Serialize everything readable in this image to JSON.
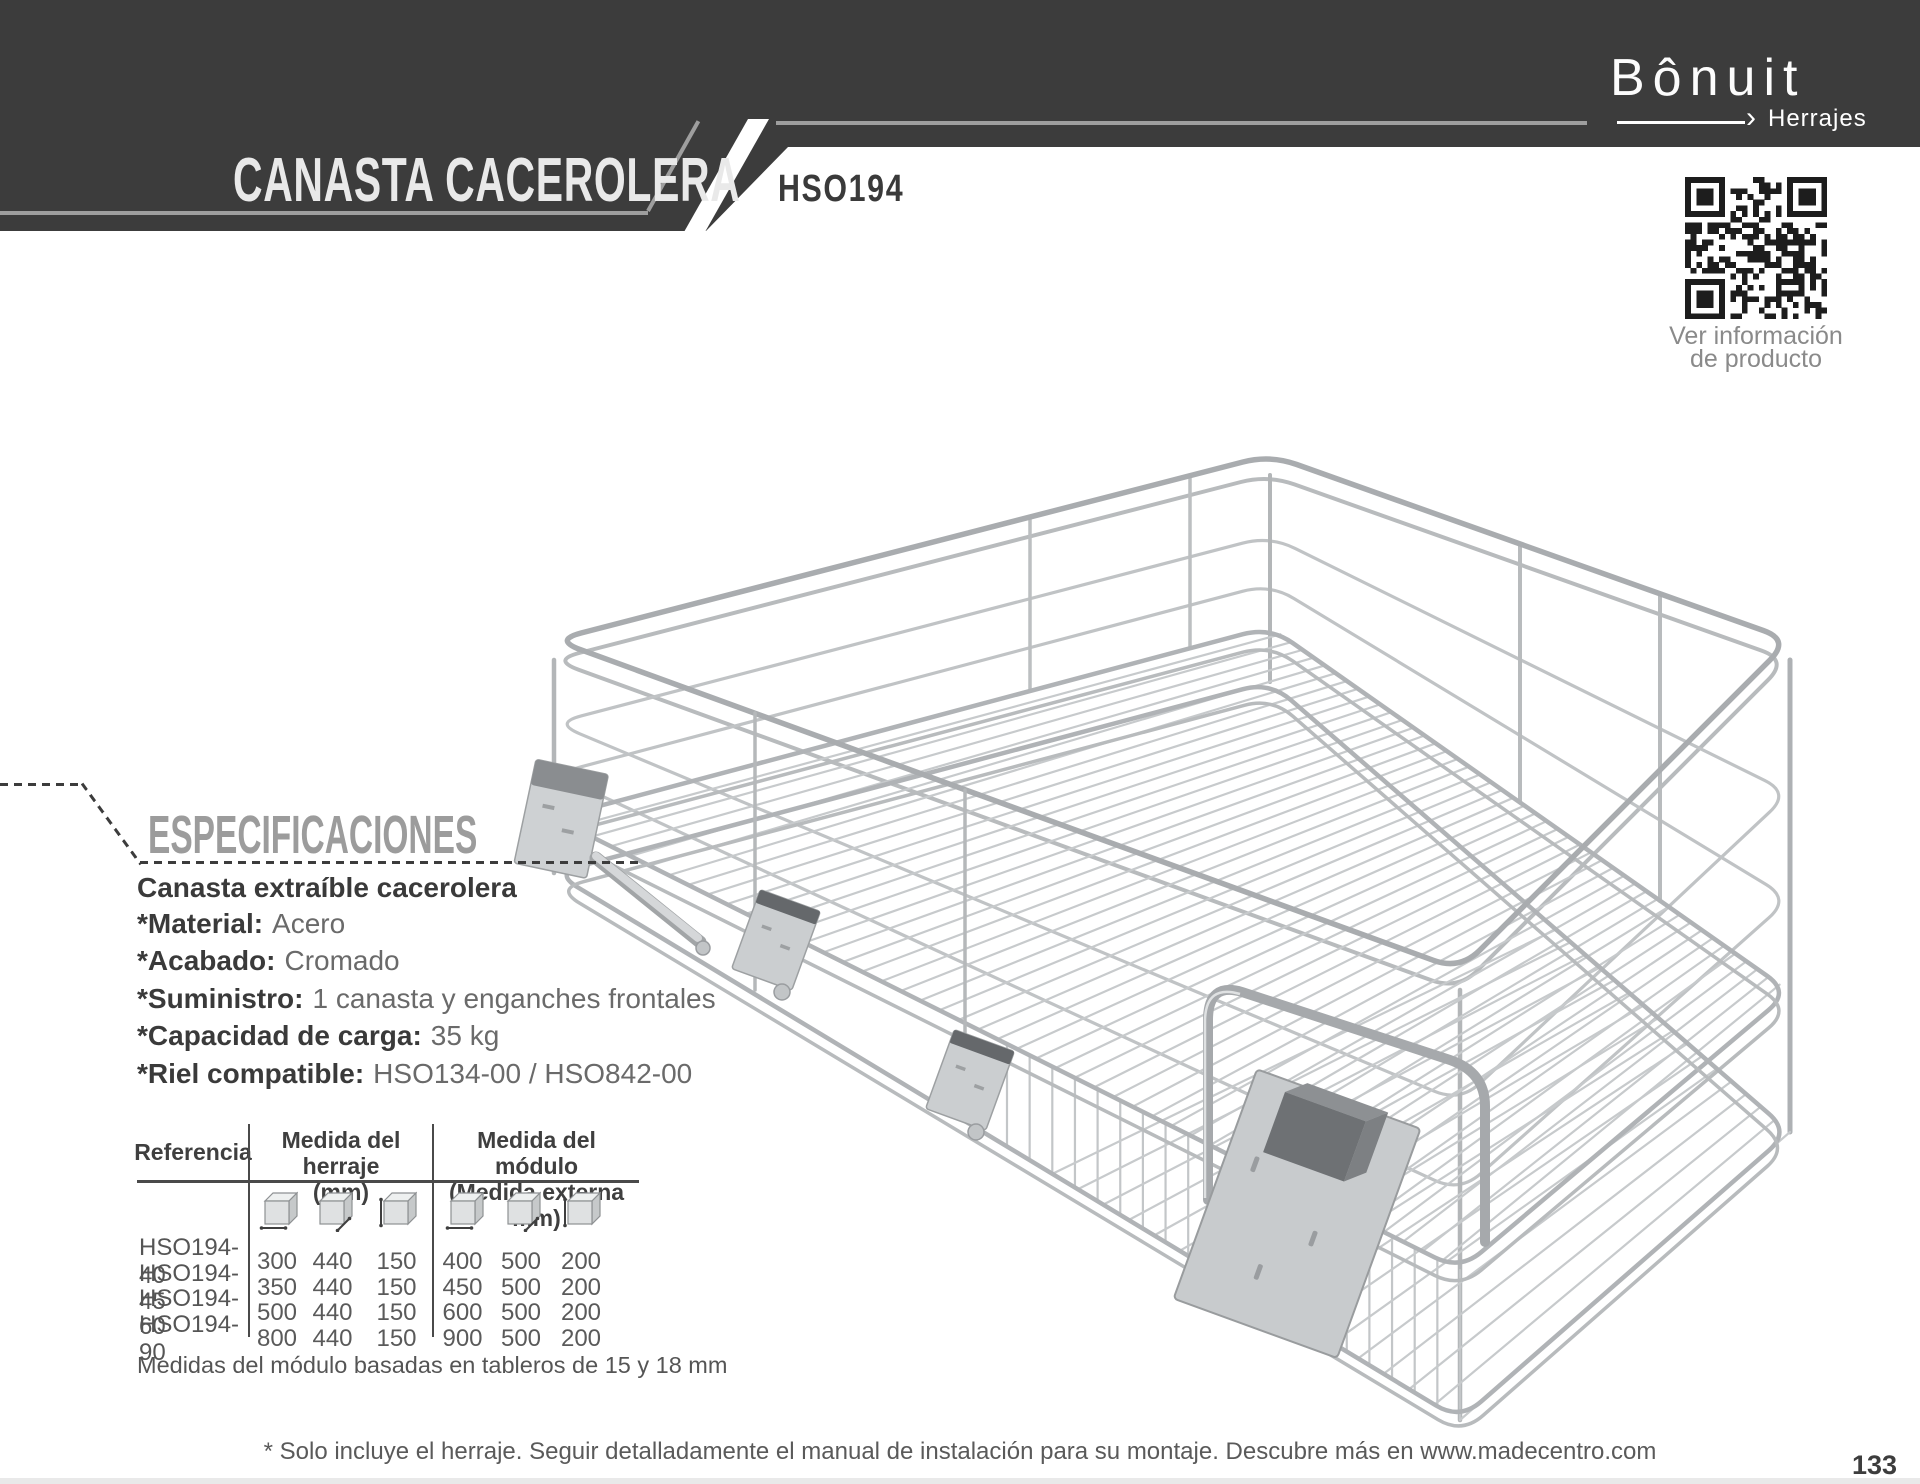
{
  "header": {
    "title": "CANASTA CACEROLERA",
    "product_code": "HSO194",
    "brand": {
      "name": "Bônuit",
      "tagline": "Herrajes",
      "arrow": "›"
    },
    "qr_caption_line1": "Ver información",
    "qr_caption_line2": "de producto"
  },
  "specifications": {
    "heading": "ESPECIFICACIONES",
    "product_name": "Canasta extraíble cacerolera",
    "items": [
      {
        "label": "*Material:",
        "value": "Acero"
      },
      {
        "label": "*Acabado:",
        "value": "Cromado"
      },
      {
        "label": "*Suministro:",
        "value": "1 canasta y enganches frontales"
      },
      {
        "label": "*Capacidad de carga:",
        "value": "35 kg"
      },
      {
        "label": "*Riel compatible:",
        "value": "HSO134-00 / HSO842-00"
      }
    ]
  },
  "table": {
    "col_ref_header": "Referencia",
    "group1_header_line1": "Medida del herraje",
    "group1_header_line2": "(mm)",
    "group2_header_line1": "Medida del módulo",
    "group2_header_line2": "(Medida externa mm)",
    "rows": [
      {
        "ref": "HSO194-40",
        "values": [
          "300",
          "440",
          "150",
          "400",
          "500",
          "200"
        ]
      },
      {
        "ref": "HSO194-45",
        "values": [
          "350",
          "440",
          "150",
          "450",
          "500",
          "200"
        ]
      },
      {
        "ref": "HSO194-60",
        "values": [
          "500",
          "440",
          "150",
          "600",
          "500",
          "200"
        ]
      },
      {
        "ref": "HSO194-90",
        "values": [
          "800",
          "440",
          "150",
          "900",
          "500",
          "200"
        ]
      }
    ],
    "note": "Medidas del módulo basadas en tableros de 15 y 18 mm"
  },
  "footer": {
    "disclaimer": "* Solo incluye el herraje. Seguir detalladamente el manual de instalación para su montaje. Descubre más en www.madecentro.com",
    "page_number": "133"
  },
  "colors": {
    "banner": "#3c3c3c",
    "banner_text": "#e9e9e9",
    "accent_line": "#9e9e9e",
    "heading_gray": "#9c9c9c",
    "label_dark": "#3a3a3a",
    "value_gray": "#6a6a6a",
    "wire_chrome": "#b2b5b7",
    "qr_dark": "#1d1d1d"
  }
}
